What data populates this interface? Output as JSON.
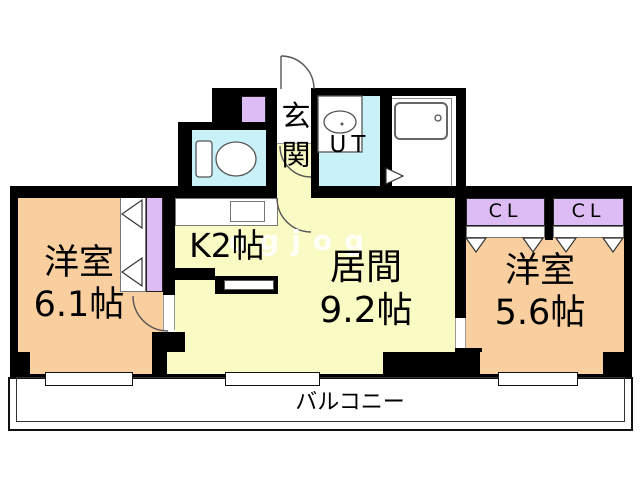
{
  "plan_title": "1LDK apartment floor plan",
  "rooms": {
    "entrance": {
      "label": "玄関"
    },
    "utility": {
      "label": "UT"
    },
    "kitchen": {
      "label": "K2帖"
    },
    "living": {
      "name": "居間",
      "size": "9.2帖"
    },
    "bedroom_left": {
      "name": "洋室",
      "size": "6.1帖"
    },
    "bedroom_right": {
      "name": "洋室",
      "size": "5.6帖"
    },
    "closet_left": {
      "label": "CL"
    },
    "closet_right": {
      "label": "CL"
    },
    "balcony": {
      "label": "バルコニー"
    }
  },
  "watermark": "ogjog",
  "colors": {
    "wall": "#000000",
    "room_orange": "#F9CFA0",
    "room_yellow": "#FAFAC5",
    "room_cyan": "#C8F2F8",
    "closet_purple": "#DCBCF2",
    "balcony_line": "#111111"
  }
}
